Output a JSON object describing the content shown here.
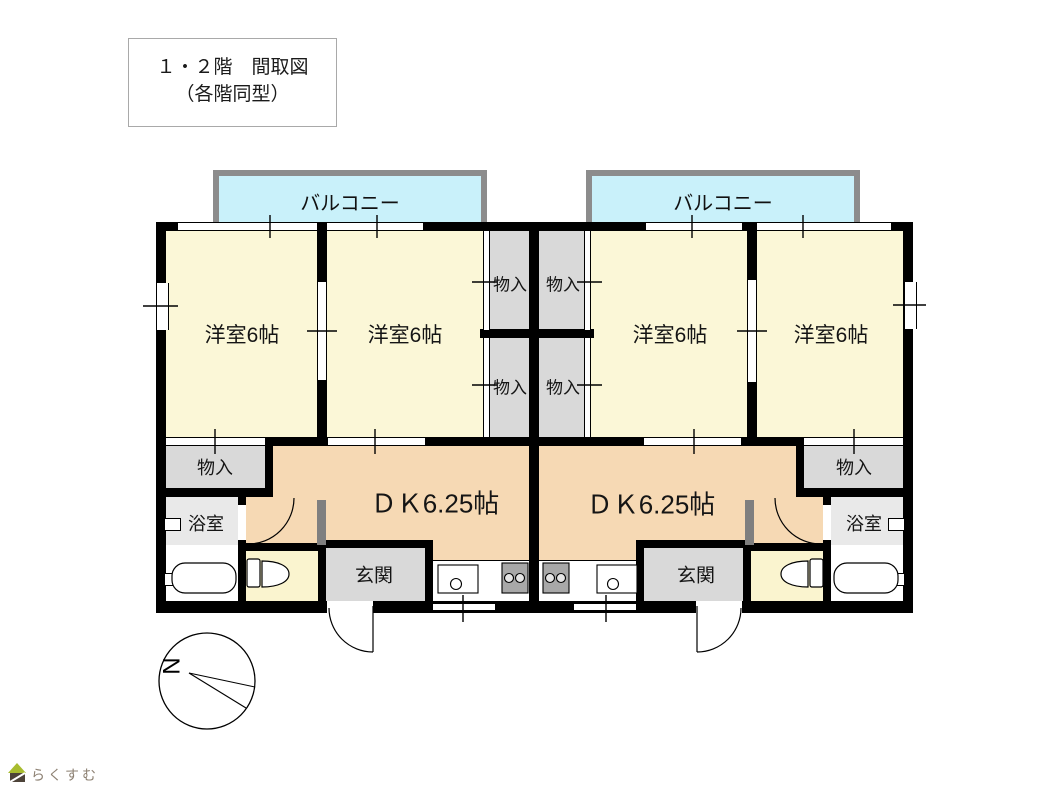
{
  "title": {
    "line1": "１・２階　間取図",
    "line2": "（各階同型）"
  },
  "labels": {
    "balcony": "バルコニー",
    "western_room": "洋室6帖",
    "storage": "物入",
    "dining_kitchen": "ＤＫ6.25帖",
    "entrance": "玄関",
    "bathroom": "浴室",
    "compass_north": "N",
    "logo_text": "らくすむ"
  },
  "colors": {
    "room_fill": "#FBF7D7",
    "dk_fill": "#F6D9B4",
    "storage_fill": "#D9D9D9",
    "bathroom_fill": "#E9E9E9",
    "kitchen_fill": "#FFFFFF",
    "balcony_fill": "#C9F1FA",
    "balcony_border": "#8C8C8C",
    "wall": "#000000",
    "door_leaf": "#7F7F7F",
    "stove": "#A8A8A8",
    "logo_roof": "#A8BC2F",
    "logo_body": "#4D4339",
    "logo_text": "#8D8173"
  }
}
